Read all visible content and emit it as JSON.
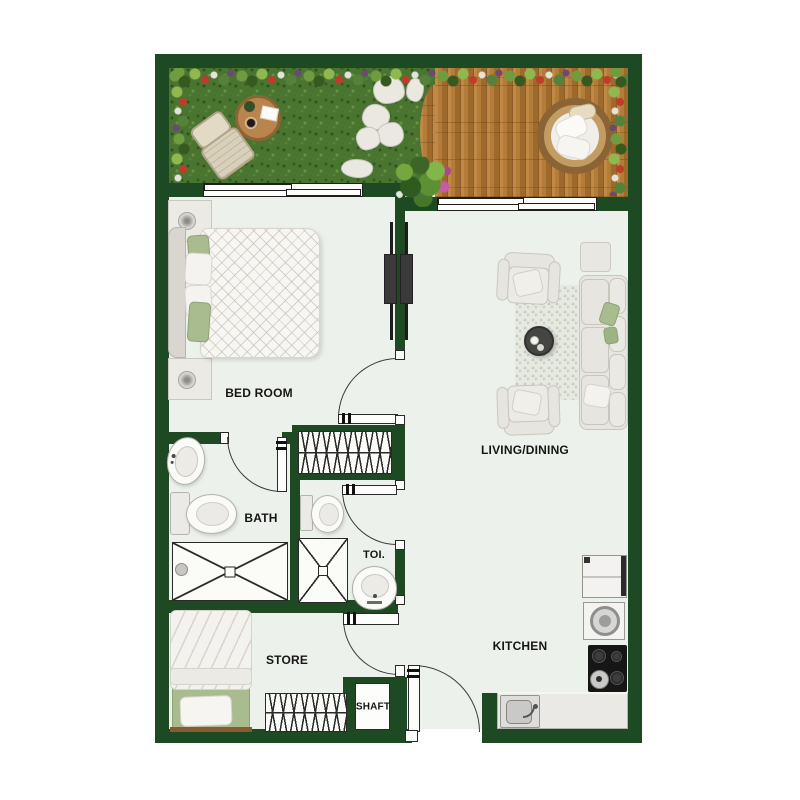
{
  "plan": {
    "title": "apartment-floor-plan",
    "rooms": [
      {
        "id": "bedroom",
        "label": "BED ROOM"
      },
      {
        "id": "living_dining",
        "label": "LIVING/DINING"
      },
      {
        "id": "bath",
        "label": "BATH"
      },
      {
        "id": "toilet",
        "label": "TOI."
      },
      {
        "id": "store",
        "label": "STORE"
      },
      {
        "id": "shaft",
        "label": "SHAFT"
      },
      {
        "id": "kitchen",
        "label": "KITCHEN"
      }
    ],
    "palette": {
      "wall": "#1d4a22",
      "floor": "#edf1eb",
      "grass": "#4a7531",
      "deck_wood": "#a9742f",
      "accent_green": "#a9bc8f",
      "outline": "#2a2a2a"
    }
  }
}
